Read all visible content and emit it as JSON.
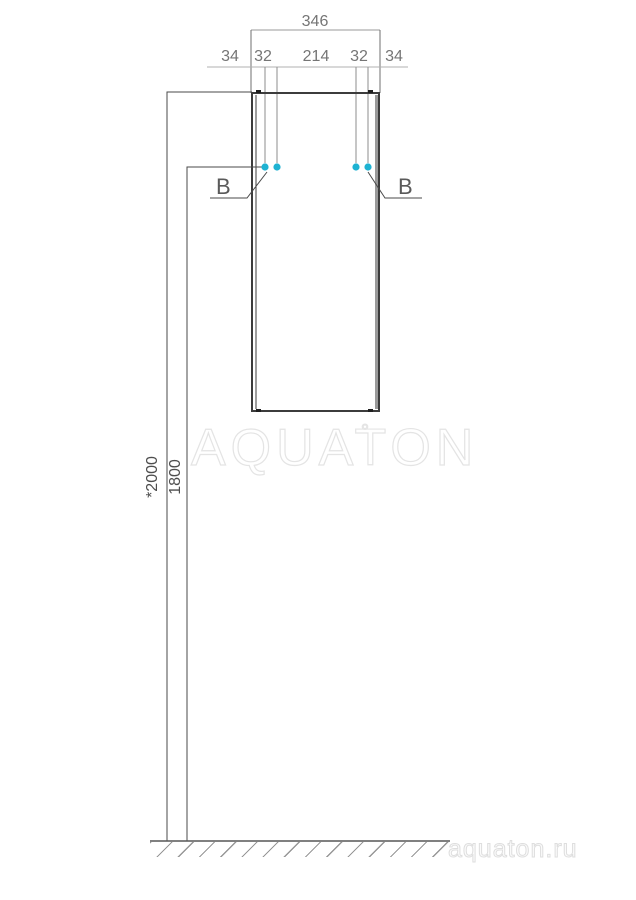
{
  "dimensions": {
    "overall_width": "346",
    "segments": [
      "34",
      "32",
      "214",
      "32",
      "34"
    ],
    "height_total": "*2000",
    "height_holes": "1800"
  },
  "details": {
    "left": "B",
    "right": "B"
  },
  "watermark": {
    "text": "AQUATON",
    "mark": "°"
  },
  "footer": {
    "site": "aquaton.ru"
  },
  "colors": {
    "hole": "#1eb2d2"
  }
}
